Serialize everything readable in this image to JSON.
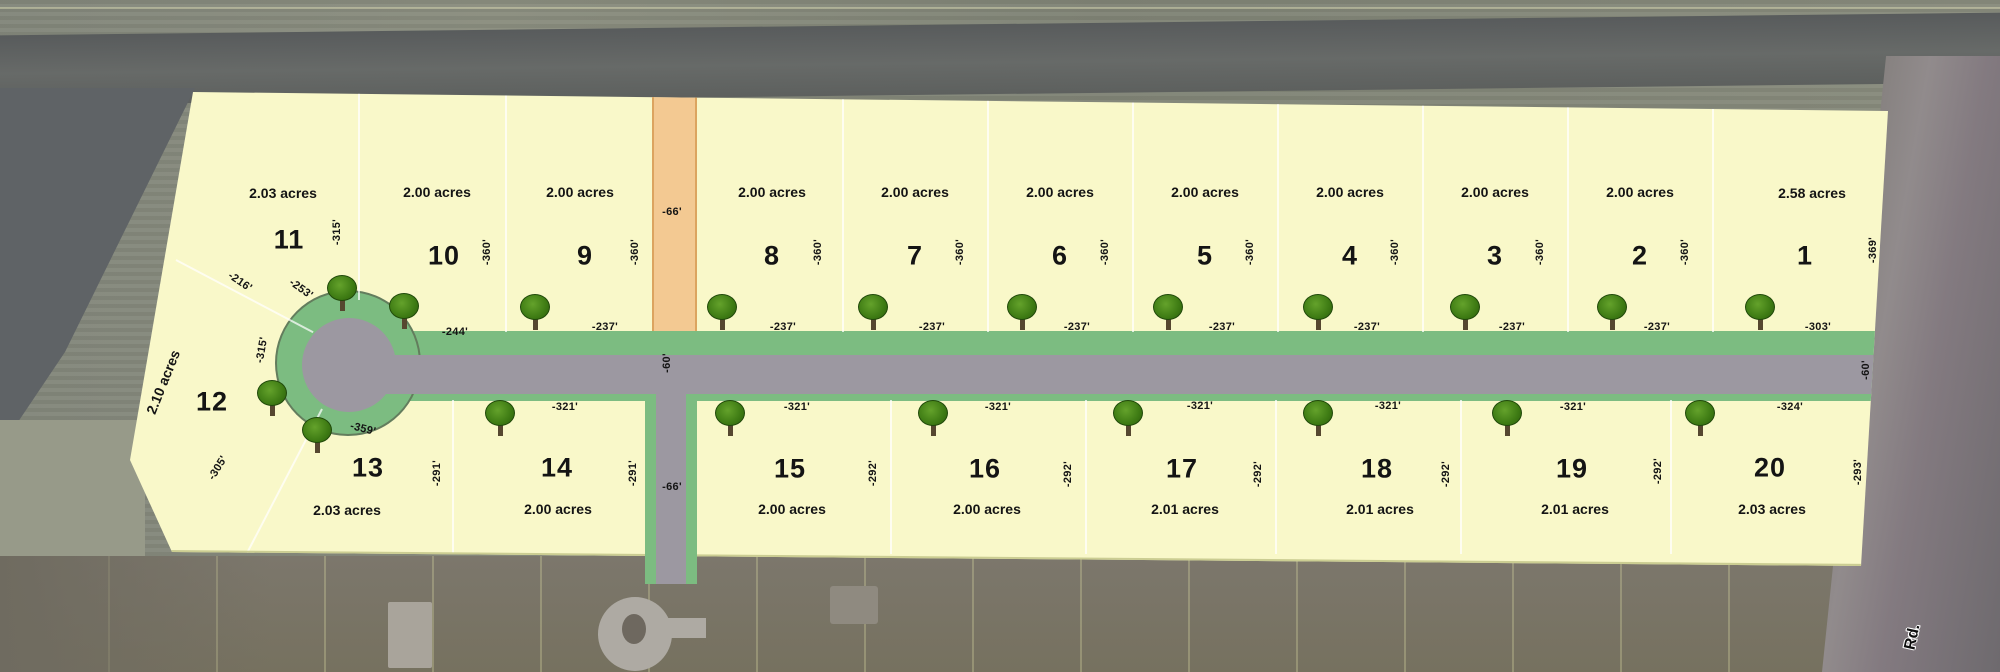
{
  "road": {
    "name": "Rd.",
    "right_of_way_width": "-66'",
    "south_right_of_way_width": "-66'",
    "pavement_width_mid": "-60'",
    "pavement_width_east": "-60'"
  },
  "lot11_dims": {
    "edge": "-216'",
    "arc": "-253'"
  },
  "lot12": {
    "number": "12",
    "acres": "2.10 acres",
    "side_dim": "-315'",
    "edge_dim": "-305'"
  },
  "lots_top": [
    {
      "number": "11",
      "acres": "2.03 acres",
      "depth": "-315'",
      "frontage": ""
    },
    {
      "number": "10",
      "acres": "2.00 acres",
      "depth": "-360'",
      "frontage": "-244'"
    },
    {
      "number": "9",
      "acres": "2.00 acres",
      "depth": "-360'",
      "frontage": "-237'"
    },
    {
      "number": "8",
      "acres": "2.00 acres",
      "depth": "-360'",
      "frontage": "-237'"
    },
    {
      "number": "7",
      "acres": "2.00 acres",
      "depth": "-360'",
      "frontage": "-237'"
    },
    {
      "number": "6",
      "acres": "2.00 acres",
      "depth": "-360'",
      "frontage": "-237'"
    },
    {
      "number": "5",
      "acres": "2.00 acres",
      "depth": "-360'",
      "frontage": "-237'"
    },
    {
      "number": "4",
      "acres": "2.00 acres",
      "depth": "-360'",
      "frontage": "-237'"
    },
    {
      "number": "3",
      "acres": "2.00 acres",
      "depth": "-360'",
      "frontage": "-237'"
    },
    {
      "number": "2",
      "acres": "2.00 acres",
      "depth": "-360'",
      "frontage": "-237'"
    },
    {
      "number": "1",
      "acres": "2.58 acres",
      "depth": "-369'",
      "frontage": "-303'"
    }
  ],
  "lots_bottom": [
    {
      "number": "13",
      "acres": "2.03 acres",
      "top_dim": "-359'",
      "side_dim": "-291'"
    },
    {
      "number": "14",
      "acres": "2.00 acres",
      "top_dim": "-321'",
      "side_dim": "-291'"
    },
    {
      "number": "15",
      "acres": "2.00 acres",
      "top_dim": "-321'",
      "side_dim": "-292'"
    },
    {
      "number": "16",
      "acres": "2.00 acres",
      "top_dim": "-321'",
      "side_dim": "-292'"
    },
    {
      "number": "17",
      "acres": "2.01 acres",
      "top_dim": "-321'",
      "side_dim": "-292'"
    },
    {
      "number": "18",
      "acres": "2.01 acres",
      "top_dim": "-321'",
      "side_dim": "-292'"
    },
    {
      "number": "19",
      "acres": "2.01 acres",
      "top_dim": "-321'",
      "side_dim": "-292'"
    },
    {
      "number": "20",
      "acres": "2.03 acres",
      "top_dim": "-324'",
      "side_dim": "-293'"
    }
  ]
}
